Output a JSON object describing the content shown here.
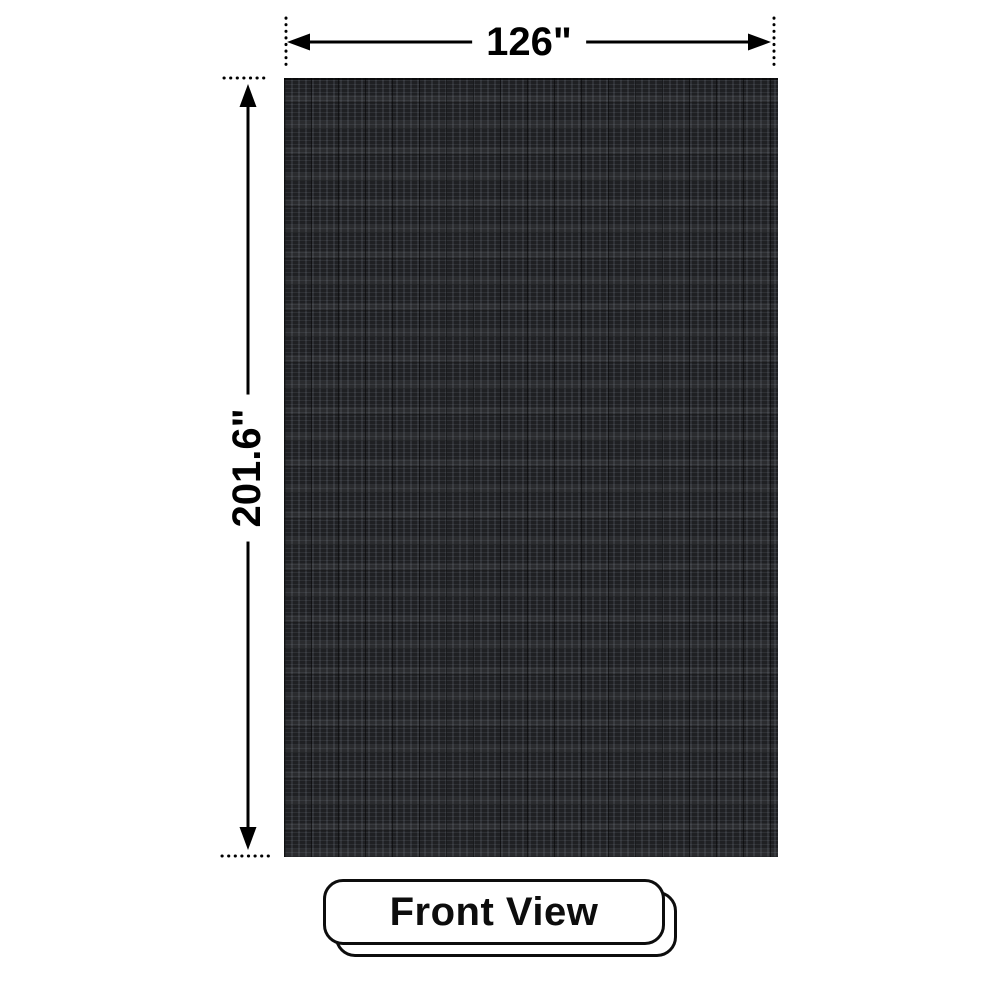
{
  "diagram": {
    "type": "product-dimension-diagram",
    "view_badge": {
      "label": "Front View"
    },
    "dimensions": {
      "width_label": "126\"",
      "height_label": "201.6\""
    },
    "panel": {
      "name": "led-display-panel-front",
      "colors": {
        "base": "#1f2023",
        "grid_light": "#43474d",
        "grid_dark": "#0c0d0e"
      }
    },
    "annotation_color": "#000000",
    "background_color": "#ffffff"
  }
}
